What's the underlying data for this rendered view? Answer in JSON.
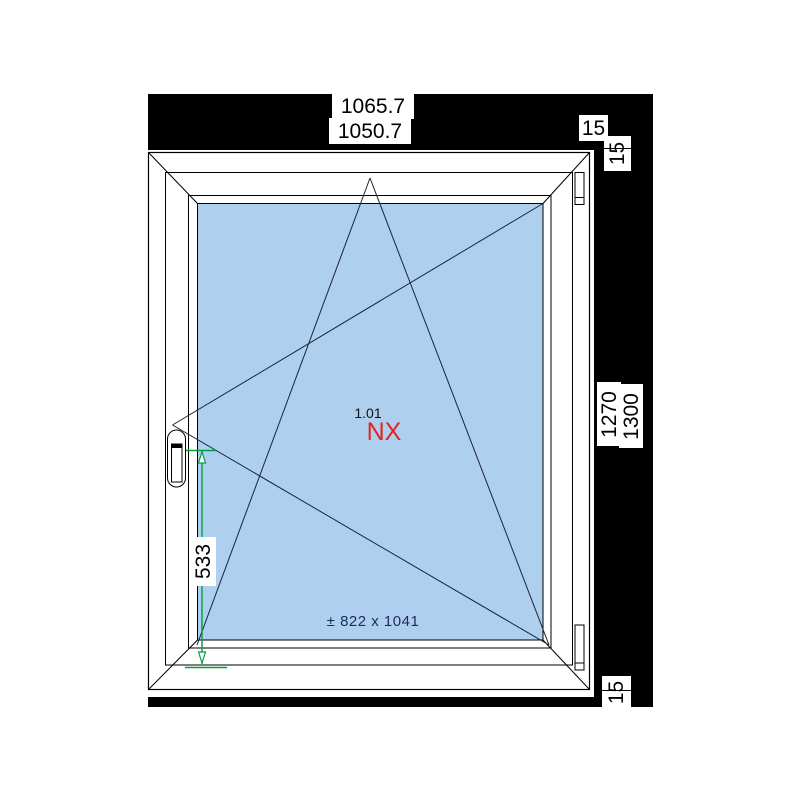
{
  "drawing": {
    "position_number": "1.01",
    "system_code": "NX",
    "glass_size": "± 822 x 1041",
    "dimensions": {
      "total_width": "1065.7",
      "frame_width": "1050.7",
      "right_extension": "15",
      "top_extension": "15",
      "frame_height": "1270",
      "total_height": "1300",
      "bottom_extension": "15",
      "handle_height": "533"
    }
  },
  "icons": {
    "opening_symbol": "tilt-turn-left-handle",
    "hinge_side": "right",
    "handle_side": "left"
  },
  "colors": {
    "margin_black": "#000000",
    "glass": "#AECFEE",
    "symbol_line": "#1c2436",
    "system_red": "#e52222",
    "glass_text": "#1f2a5a",
    "dimension_green": "#00a040"
  }
}
